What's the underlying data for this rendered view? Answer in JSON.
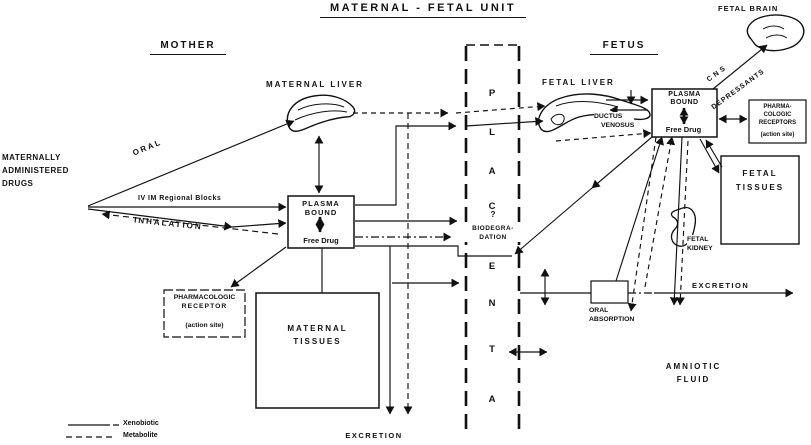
{
  "title": "MATERNAL - FETAL  UNIT",
  "mother": {
    "heading": "MOTHER",
    "source": [
      "MATERNALLY",
      "ADMINISTERED",
      "DRUGS"
    ],
    "routes": {
      "oral": "ORAL",
      "iv_im": "IV    IM   Regional  Blocks",
      "inhalation": "INHALATION"
    },
    "liver_label": "MATERNAL LIVER",
    "plasma_box": {
      "bound1": "PLASMA",
      "bound2": "BOUND",
      "free": "Free Drug"
    },
    "receptor_box": {
      "l1": "PHARMACOLOGIC",
      "l2": "RECEPTOR",
      "l3": "(action site)"
    },
    "tissues": [
      "MATERNAL",
      "TISSUES"
    ],
    "excretion": "EXCRETION"
  },
  "placenta": {
    "letters": [
      "P",
      "L",
      "A",
      "C",
      "E",
      "N",
      "T",
      "A"
    ],
    "question": "?",
    "biodeg": [
      "BIODEGRA-",
      "DATION"
    ]
  },
  "fetus": {
    "heading": "FETUS",
    "liver_label": "FETAL LIVER",
    "ductus": [
      "DUCTUS",
      "VENOSUS"
    ],
    "plasma_box": {
      "bound1": "PLASMA",
      "bound2": "BOUND",
      "free": "Free Drug"
    },
    "brain_label": "FETAL BRAIN",
    "cns": [
      "CNS",
      "DEPRESSANTS"
    ],
    "receptors_box": {
      "l1": "PHARMA-",
      "l2": "COLOGIC",
      "l3": "RECEPTORS",
      "l4": "(action site)"
    },
    "tissues": [
      "FETAL",
      "TISSUES"
    ],
    "kidney": [
      "FETAL",
      "KIDNEY"
    ],
    "excretion": "EXCRETION",
    "oral_absorption": [
      "ORAL",
      "ABSORPTION"
    ],
    "amniotic": [
      "AMNIOTIC",
      "FLUID"
    ]
  },
  "legend": {
    "xenobiotic": "Xenobiotic",
    "metabolite": "Metabolite"
  },
  "colors": {
    "ink": "#111111",
    "background": "#ffffff"
  }
}
